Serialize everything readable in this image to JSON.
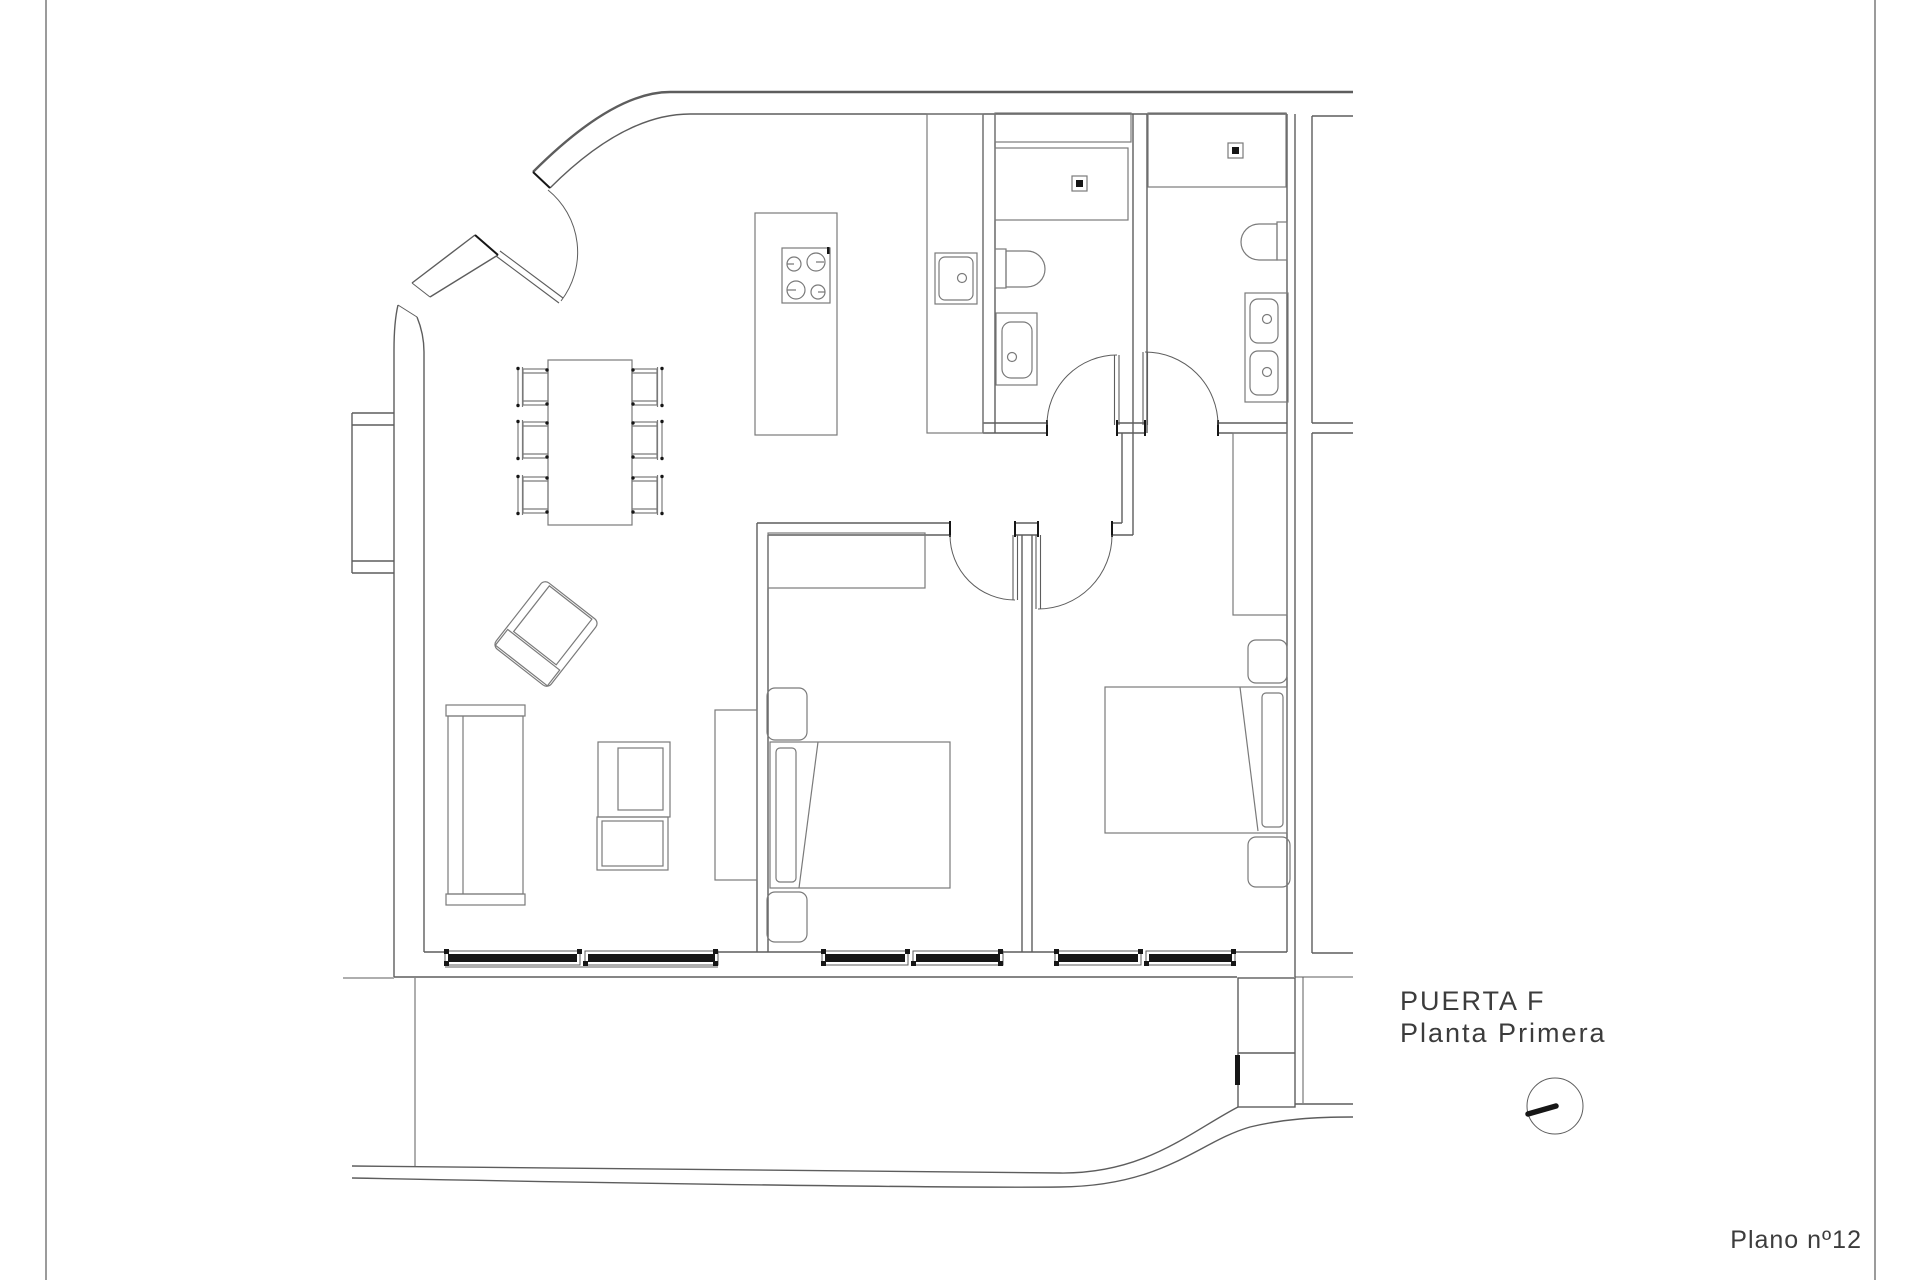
{
  "sheet": {
    "background": "#ffffff",
    "plan_number": "Plano nº12"
  },
  "title_block": {
    "line1": "PUERTA F",
    "line2": "Planta Primera"
  },
  "colors": {
    "wall": "#5d5d5d",
    "furniture": "#7a7a7a",
    "dark": "#161616",
    "text": "#3c3c3c",
    "frame": "#9b9b9b"
  }
}
